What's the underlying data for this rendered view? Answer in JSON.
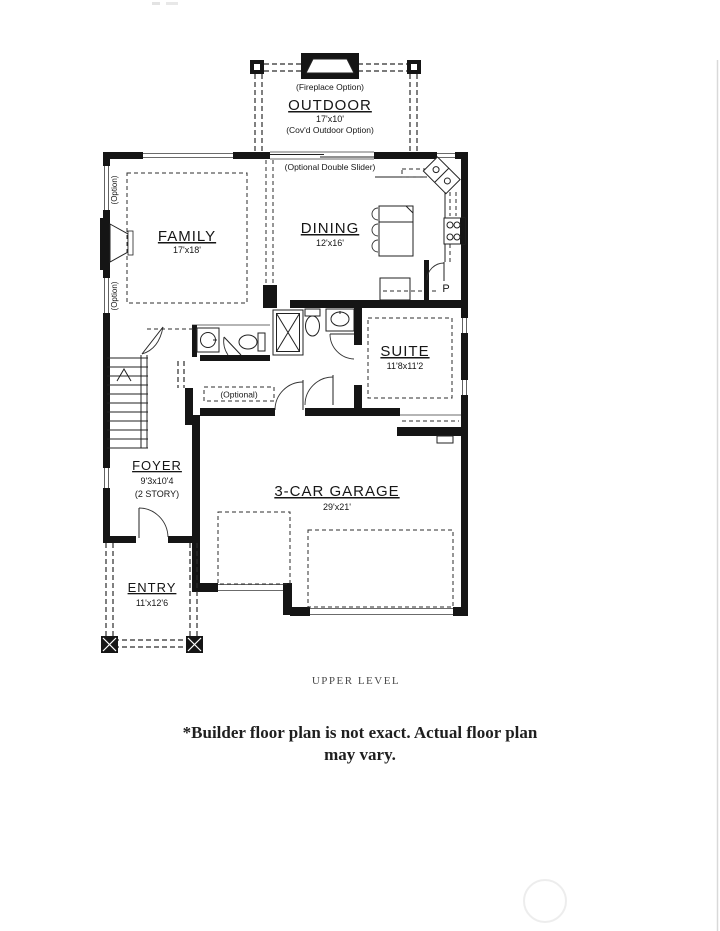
{
  "rooms": {
    "outdoor": {
      "name": "OUTDOOR",
      "dims": "17'x10'",
      "note": "(Cov'd Outdoor Option)",
      "fireplace_note": "(Fireplace Option)"
    },
    "dining": {
      "name": "DINING",
      "dims": "12'x16'",
      "slider_note": "(Optional Double Slider)",
      "pantry_label": "P"
    },
    "family": {
      "name": "FAMILY",
      "dims": "17'x18'",
      "option_top": "(Option)",
      "option_bottom": "(Option)"
    },
    "suite": {
      "name": "SUITE",
      "dims": "11'8x11'2"
    },
    "foyer": {
      "name": "FOYER",
      "dims": "9'3x10'4",
      "note": "(2 STORY)",
      "hall_note": "(Optional)"
    },
    "garage": {
      "name": "3-CAR GARAGE",
      "dims": "29'x21'"
    },
    "entry": {
      "name": "ENTRY",
      "dims": "11'x12'6"
    }
  },
  "footer": {
    "level": "UPPER LEVEL",
    "disclaimer_line1": "*Builder floor plan is not exact. Actual floor plan",
    "disclaimer_line2": "may vary."
  },
  "colors": {
    "wall": "#151515",
    "background": "#ffffff"
  }
}
